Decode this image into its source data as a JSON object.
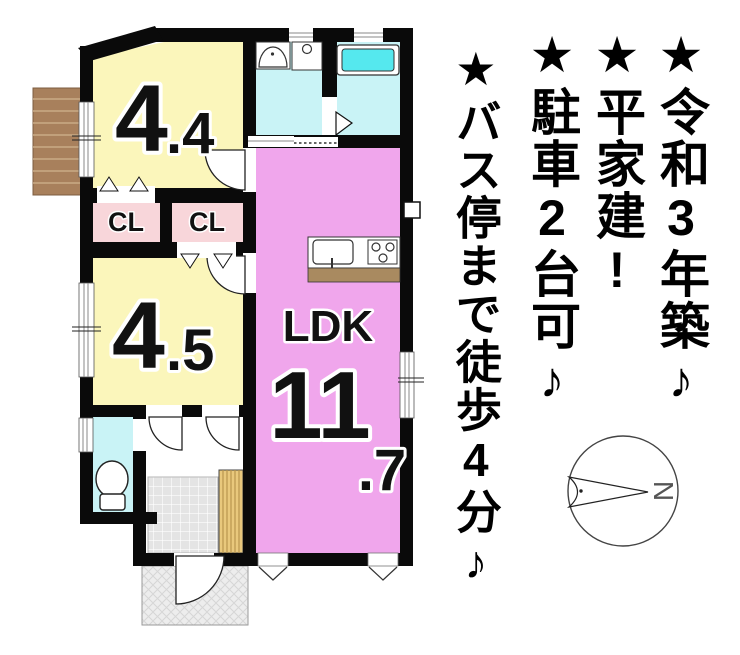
{
  "plan": {
    "rooms": [
      {
        "num": "4",
        "dec": ".4"
      },
      {
        "num": "4",
        "dec": ".5"
      }
    ],
    "closets": [
      {
        "label": "CL"
      },
      {
        "label": "CL"
      }
    ],
    "ldk": {
      "label": "LDK",
      "num": "11",
      "dec": ".7"
    },
    "colors": {
      "room_yellow": "#fbf6bb",
      "ldk_pink": "#f0a6ec",
      "closet_pink": "#f8d6da",
      "wet_cyan": "#c9f3f6",
      "tub_cyan": "#55e8ee",
      "deck_brown": "#a8805c",
      "counter_brown": "#a98a60",
      "step_wood": "#e9c87c",
      "wall_black": "#0a0a0a"
    }
  },
  "notes": [
    {
      "text": "★令和3年築♪"
    },
    {
      "text": "★平家建!"
    },
    {
      "text": "★駐車2台可♪"
    },
    {
      "text": "★バス停まで徒歩4分♪"
    }
  ],
  "compass": {
    "north_label": "N"
  }
}
